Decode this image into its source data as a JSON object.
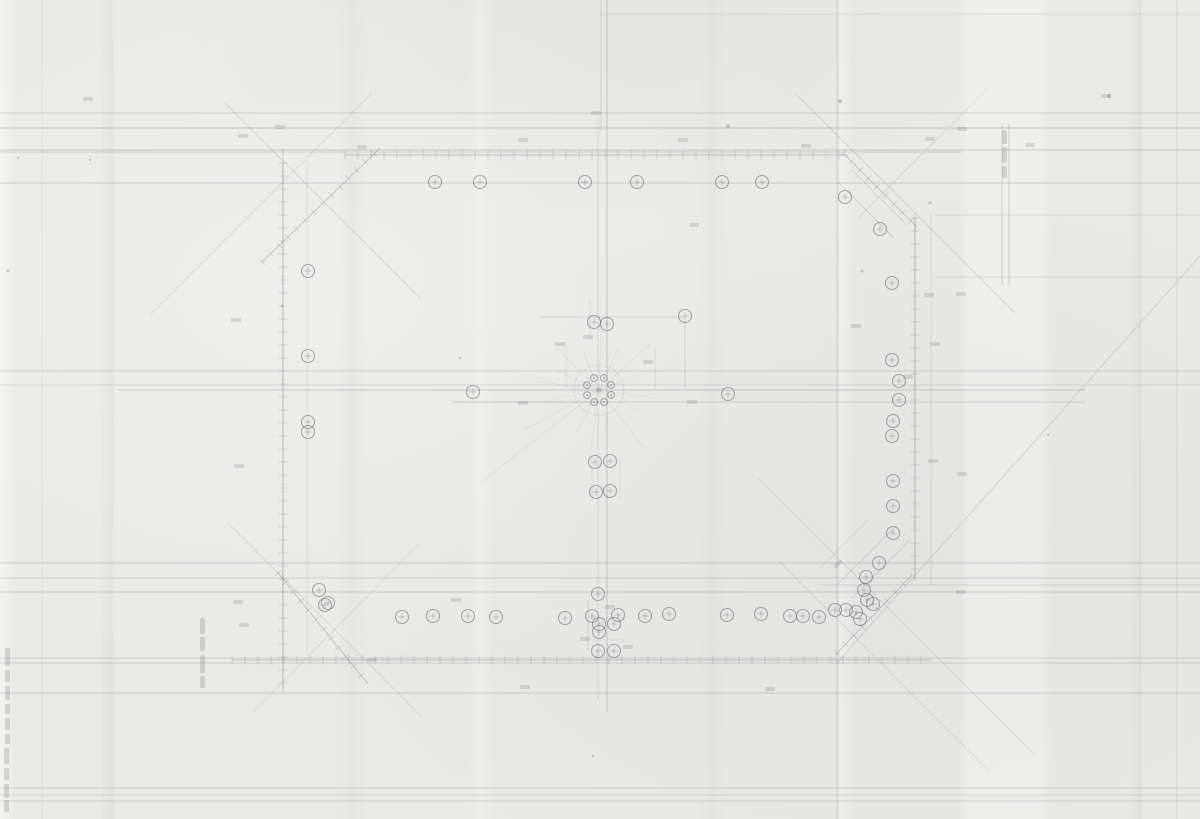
{
  "document": {
    "kind": "scanned pencil site-plan drawing",
    "legible_text": [],
    "colors": {
      "paper": "#e9e9e6",
      "ink": "#5c5c66"
    }
  },
  "drawing": {
    "width": 1200,
    "height": 819,
    "ink": "#5c5c66",
    "hlines": [
      {
        "y": 14,
        "x1": 600,
        "x2": 1200,
        "o": 0.12
      },
      {
        "y": 113,
        "x1": 0,
        "x2": 1200,
        "o": 0.22
      },
      {
        "y": 128,
        "x1": 0,
        "x2": 1200,
        "o": 0.3
      },
      {
        "y": 150,
        "x1": 0,
        "x2": 1200,
        "o": 0.26
      },
      {
        "y": 152,
        "x1": 0,
        "x2": 962,
        "o": 0.2
      },
      {
        "y": 183,
        "x1": 0,
        "x2": 1200,
        "o": 0.24
      },
      {
        "y": 215,
        "x1": 935,
        "x2": 1200,
        "o": 0.16
      },
      {
        "y": 277,
        "x1": 935,
        "x2": 1200,
        "o": 0.16
      },
      {
        "y": 371,
        "x1": 0,
        "x2": 1200,
        "o": 0.2
      },
      {
        "y": 385,
        "x1": 0,
        "x2": 1200,
        "o": 0.16
      },
      {
        "y": 390,
        "x1": 118,
        "x2": 1085,
        "o": 0.26
      },
      {
        "y": 402,
        "x1": 452,
        "x2": 1085,
        "o": 0.18
      },
      {
        "y": 563,
        "x1": 0,
        "x2": 1200,
        "o": 0.24
      },
      {
        "y": 578,
        "x1": 0,
        "x2": 1200,
        "o": 0.2
      },
      {
        "y": 585,
        "x1": 820,
        "x2": 1200,
        "o": 0.18
      },
      {
        "y": 592,
        "x1": 0,
        "x2": 1200,
        "o": 0.24
      },
      {
        "y": 658,
        "x1": 0,
        "x2": 1200,
        "o": 0.22
      },
      {
        "y": 663,
        "x1": 0,
        "x2": 1200,
        "o": 0.2
      },
      {
        "y": 693,
        "x1": 0,
        "x2": 1200,
        "o": 0.24
      },
      {
        "y": 788,
        "x1": 0,
        "x2": 1200,
        "o": 0.2
      },
      {
        "y": 795,
        "x1": 0,
        "x2": 1200,
        "o": 0.16
      },
      {
        "y": 801,
        "x1": 0,
        "x2": 1200,
        "o": 0.2
      }
    ],
    "vlines": [
      {
        "x": 283,
        "y1": 148,
        "y2": 692,
        "o": 0.2
      },
      {
        "x": 307,
        "y1": 160,
        "y2": 655,
        "o": 0.12
      },
      {
        "x": 598,
        "y1": 118,
        "y2": 700,
        "o": 0.18
      },
      {
        "x": 607,
        "y1": 0,
        "y2": 712,
        "o": 0.3
      },
      {
        "x": 601,
        "y1": 0,
        "y2": 130,
        "o": 0.2
      },
      {
        "x": 915,
        "y1": 214,
        "y2": 580,
        "o": 0.2
      },
      {
        "x": 931,
        "y1": 214,
        "y2": 586,
        "o": 0.14
      },
      {
        "x": 1002,
        "y1": 124,
        "y2": 286,
        "o": 0.25
      },
      {
        "x": 1009,
        "y1": 124,
        "y2": 286,
        "o": 0.25
      },
      {
        "x": 1140,
        "y1": 0,
        "y2": 819,
        "o": 0.14
      },
      {
        "x": 1177,
        "y1": 0,
        "y2": 819,
        "o": 0.14
      },
      {
        "x": 112,
        "y1": 0,
        "y2": 819,
        "o": 0.08
      },
      {
        "x": 42,
        "y1": 0,
        "y2": 819,
        "o": 0.08
      }
    ],
    "tick_lines": [
      {
        "x1": 345,
        "y1": 155,
        "x2": 848,
        "y2": 155,
        "step": 13,
        "tick": 9,
        "o": 0.3
      },
      {
        "x1": 232,
        "y1": 660,
        "x2": 932,
        "y2": 660,
        "step": 13,
        "tick": 9,
        "o": 0.3
      },
      {
        "x1": 283,
        "y1": 163,
        "x2": 283,
        "y2": 688,
        "step": 13,
        "tick": 9,
        "o": 0.28
      },
      {
        "x1": 915,
        "y1": 218,
        "x2": 915,
        "y2": 577,
        "step": 13,
        "tick": 9,
        "o": 0.28
      },
      {
        "x1": 262,
        "y1": 262,
        "x2": 380,
        "y2": 148,
        "step": 12,
        "tick": 8,
        "o": 0.28
      },
      {
        "x1": 843,
        "y1": 153,
        "x2": 917,
        "y2": 227,
        "step": 12,
        "tick": 8,
        "o": 0.28
      },
      {
        "x1": 278,
        "y1": 573,
        "x2": 368,
        "y2": 684,
        "step": 12,
        "tick": 8,
        "o": 0.3
      },
      {
        "x1": 912,
        "y1": 575,
        "x2": 835,
        "y2": 655,
        "step": 12,
        "tick": 8,
        "o": 0.3
      }
    ],
    "dlines": [
      {
        "x1": 225,
        "y1": 103,
        "x2": 420,
        "y2": 298,
        "o": 0.18
      },
      {
        "x1": 150,
        "y1": 315,
        "x2": 372,
        "y2": 93,
        "o": 0.15
      },
      {
        "x1": 795,
        "y1": 93,
        "x2": 1015,
        "y2": 313,
        "o": 0.2
      },
      {
        "x1": 988,
        "y1": 88,
        "x2": 858,
        "y2": 218,
        "o": 0.15
      },
      {
        "x1": 1200,
        "y1": 256,
        "x2": 836,
        "y2": 664,
        "o": 0.2
      },
      {
        "x1": 758,
        "y1": 478,
        "x2": 1035,
        "y2": 755,
        "o": 0.16
      },
      {
        "x1": 780,
        "y1": 562,
        "x2": 988,
        "y2": 770,
        "o": 0.14
      },
      {
        "x1": 228,
        "y1": 523,
        "x2": 422,
        "y2": 717,
        "o": 0.15
      },
      {
        "x1": 420,
        "y1": 543,
        "x2": 253,
        "y2": 712,
        "o": 0.15
      },
      {
        "x1": 540,
        "y1": 317,
        "x2": 683,
        "y2": 317,
        "o": 0.22
      },
      {
        "x1": 685,
        "y1": 320,
        "x2": 685,
        "y2": 388,
        "o": 0.2
      },
      {
        "x1": 655,
        "y1": 347,
        "x2": 655,
        "y2": 390,
        "o": 0.16
      },
      {
        "x1": 455,
        "y1": 402,
        "x2": 600,
        "y2": 402,
        "o": 0.2
      },
      {
        "x1": 838,
        "y1": 182,
        "x2": 893,
        "y2": 237,
        "o": 0.22
      },
      {
        "x1": 852,
        "y1": 170,
        "x2": 907,
        "y2": 225,
        "o": 0.18
      },
      {
        "x1": 838,
        "y1": 584,
        "x2": 897,
        "y2": 525,
        "o": 0.2
      },
      {
        "x1": 852,
        "y1": 598,
        "x2": 911,
        "y2": 539,
        "o": 0.18
      },
      {
        "x1": 820,
        "y1": 568,
        "x2": 868,
        "y2": 520,
        "o": 0.14
      },
      {
        "x1": 588,
        "y1": 600,
        "x2": 588,
        "y2": 650,
        "o": 0.2
      },
      {
        "x1": 590,
        "y1": 618,
        "x2": 624,
        "y2": 618,
        "o": 0.16
      },
      {
        "x1": 590,
        "y1": 640,
        "x2": 624,
        "y2": 640,
        "o": 0.14
      },
      {
        "x1": 566,
        "y1": 342,
        "x2": 566,
        "y2": 388,
        "o": 0.14
      },
      {
        "x1": 590,
        "y1": 300,
        "x2": 590,
        "y2": 340,
        "o": 0.14
      },
      {
        "x1": 620,
        "y1": 455,
        "x2": 620,
        "y2": 500,
        "o": 0.14
      },
      {
        "x1": 592,
        "y1": 455,
        "x2": 592,
        "y2": 500,
        "o": 0.14
      }
    ],
    "circles": [
      {
        "x": 435,
        "y": 182
      },
      {
        "x": 480,
        "y": 182
      },
      {
        "x": 585,
        "y": 182
      },
      {
        "x": 637,
        "y": 182
      },
      {
        "x": 722,
        "y": 182
      },
      {
        "x": 762,
        "y": 182
      },
      {
        "x": 845,
        "y": 197
      },
      {
        "x": 880,
        "y": 229
      },
      {
        "x": 308,
        "y": 271
      },
      {
        "x": 308,
        "y": 356
      },
      {
        "x": 308,
        "y": 422
      },
      {
        "x": 308,
        "y": 432
      },
      {
        "x": 892,
        "y": 283
      },
      {
        "x": 892,
        "y": 360
      },
      {
        "x": 899,
        "y": 381
      },
      {
        "x": 899,
        "y": 400
      },
      {
        "x": 893,
        "y": 421
      },
      {
        "x": 892,
        "y": 436
      },
      {
        "x": 893,
        "y": 481
      },
      {
        "x": 893,
        "y": 506
      },
      {
        "x": 893,
        "y": 533
      },
      {
        "x": 319,
        "y": 590
      },
      {
        "x": 328,
        "y": 603
      },
      {
        "x": 325,
        "y": 605
      },
      {
        "x": 402,
        "y": 617
      },
      {
        "x": 433,
        "y": 616
      },
      {
        "x": 468,
        "y": 616
      },
      {
        "x": 496,
        "y": 617
      },
      {
        "x": 565,
        "y": 618
      },
      {
        "x": 592,
        "y": 616
      },
      {
        "x": 618,
        "y": 615
      },
      {
        "x": 645,
        "y": 616
      },
      {
        "x": 669,
        "y": 614
      },
      {
        "x": 727,
        "y": 615
      },
      {
        "x": 761,
        "y": 614
      },
      {
        "x": 790,
        "y": 616
      },
      {
        "x": 803,
        "y": 616
      },
      {
        "x": 819,
        "y": 617
      },
      {
        "x": 835,
        "y": 610
      },
      {
        "x": 846,
        "y": 610
      },
      {
        "x": 856,
        "y": 612
      },
      {
        "x": 860,
        "y": 619
      },
      {
        "x": 867,
        "y": 600
      },
      {
        "x": 864,
        "y": 590
      },
      {
        "x": 866,
        "y": 577
      },
      {
        "x": 873,
        "y": 604
      },
      {
        "x": 879,
        "y": 563
      },
      {
        "x": 594,
        "y": 322
      },
      {
        "x": 607,
        "y": 324
      },
      {
        "x": 685,
        "y": 316
      },
      {
        "x": 728,
        "y": 394
      },
      {
        "x": 473,
        "y": 392
      },
      {
        "x": 595,
        "y": 462
      },
      {
        "x": 610,
        "y": 461
      },
      {
        "x": 596,
        "y": 492
      },
      {
        "x": 610,
        "y": 491
      },
      {
        "x": 598,
        "y": 594
      },
      {
        "x": 599,
        "y": 624
      },
      {
        "x": 614,
        "y": 624
      },
      {
        "x": 599,
        "y": 632
      },
      {
        "x": 598,
        "y": 651
      },
      {
        "x": 614,
        "y": 651
      }
    ],
    "circle_r": 6.5,
    "ring": {
      "cx": 599,
      "cy": 390,
      "r_outer": 25,
      "r_ring": 13,
      "n": 8,
      "r_small": 3.4
    },
    "rays": [
      {
        "a": 8,
        "len": 60
      },
      {
        "a": 28,
        "len": 42
      },
      {
        "a": 52,
        "len": 75
      },
      {
        "a": 75,
        "len": 38
      },
      {
        "a": 98,
        "len": 60
      },
      {
        "a": 118,
        "len": 48
      },
      {
        "a": 142,
        "len": 150
      },
      {
        "a": 152,
        "len": 85
      },
      {
        "a": 168,
        "len": 55
      },
      {
        "a": 188,
        "len": 70
      },
      {
        "a": 205,
        "len": 48
      },
      {
        "a": 225,
        "len": 60
      },
      {
        "a": 248,
        "len": 42
      },
      {
        "a": 272,
        "len": 66
      },
      {
        "a": 295,
        "len": 45
      },
      {
        "a": 318,
        "len": 70
      },
      {
        "a": 338,
        "len": 50
      }
    ],
    "smudges": [
      {
        "x": 88,
        "y": 99
      },
      {
        "x": 243,
        "y": 136
      },
      {
        "x": 280,
        "y": 127
      },
      {
        "x": 362,
        "y": 147
      },
      {
        "x": 523,
        "y": 140
      },
      {
        "x": 596,
        "y": 113
      },
      {
        "x": 683,
        "y": 140
      },
      {
        "x": 806,
        "y": 146
      },
      {
        "x": 930,
        "y": 139
      },
      {
        "x": 1030,
        "y": 145
      },
      {
        "x": 1106,
        "y": 96
      },
      {
        "x": 236,
        "y": 320
      },
      {
        "x": 239,
        "y": 466
      },
      {
        "x": 238,
        "y": 602
      },
      {
        "x": 244,
        "y": 625
      },
      {
        "x": 560,
        "y": 344
      },
      {
        "x": 588,
        "y": 337
      },
      {
        "x": 648,
        "y": 362
      },
      {
        "x": 692,
        "y": 402
      },
      {
        "x": 523,
        "y": 403
      },
      {
        "x": 929,
        "y": 295
      },
      {
        "x": 961,
        "y": 294
      },
      {
        "x": 935,
        "y": 344
      },
      {
        "x": 962,
        "y": 474
      },
      {
        "x": 961,
        "y": 592
      },
      {
        "x": 933,
        "y": 461
      },
      {
        "x": 838,
        "y": 564,
        "angle": -45
      },
      {
        "x": 856,
        "y": 326
      },
      {
        "x": 908,
        "y": 377
      },
      {
        "x": 456,
        "y": 600
      },
      {
        "x": 525,
        "y": 687
      },
      {
        "x": 770,
        "y": 689
      },
      {
        "x": 372,
        "y": 660
      },
      {
        "x": 585,
        "y": 639
      },
      {
        "x": 628,
        "y": 647
      },
      {
        "x": 610,
        "y": 607
      },
      {
        "x": 694,
        "y": 225
      },
      {
        "x": 962,
        "y": 129
      }
    ],
    "vmarks": [
      {
        "x": 1002,
        "y": 130,
        "h": 14
      },
      {
        "x": 1002,
        "y": 147,
        "h": 16
      },
      {
        "x": 1002,
        "y": 166,
        "h": 12
      },
      {
        "x": 200,
        "y": 618,
        "h": 16
      },
      {
        "x": 200,
        "y": 637,
        "h": 14
      },
      {
        "x": 200,
        "y": 655,
        "h": 18
      },
      {
        "x": 200,
        "y": 676,
        "h": 12
      },
      {
        "x": 5,
        "y": 648,
        "h": 18
      },
      {
        "x": 5,
        "y": 670,
        "h": 12
      },
      {
        "x": 5,
        "y": 686,
        "h": 14
      },
      {
        "x": 5,
        "y": 704,
        "h": 10
      },
      {
        "x": 5,
        "y": 718,
        "h": 12
      },
      {
        "x": 5,
        "y": 734,
        "h": 10
      },
      {
        "x": 4,
        "y": 748,
        "h": 16
      },
      {
        "x": 4,
        "y": 768,
        "h": 12
      },
      {
        "x": 4,
        "y": 784,
        "h": 14
      },
      {
        "x": 4,
        "y": 800,
        "h": 12
      }
    ],
    "specks": [
      {
        "x": 728,
        "y": 126,
        "r": 2
      },
      {
        "x": 840,
        "y": 101,
        "r": 2
      },
      {
        "x": 862,
        "y": 271,
        "r": 1.5
      },
      {
        "x": 1109,
        "y": 96,
        "r": 2
      },
      {
        "x": 90,
        "y": 160,
        "r": 1.2
      },
      {
        "x": 8,
        "y": 271,
        "r": 1.5
      },
      {
        "x": 18,
        "y": 158,
        "r": 1.2
      },
      {
        "x": 930,
        "y": 203,
        "r": 1.5
      },
      {
        "x": 460,
        "y": 358,
        "r": 1.2
      },
      {
        "x": 593,
        "y": 756,
        "r": 1.3
      },
      {
        "x": 282,
        "y": 306,
        "r": 1.2
      },
      {
        "x": 1048,
        "y": 435,
        "r": 1.2
      }
    ]
  }
}
